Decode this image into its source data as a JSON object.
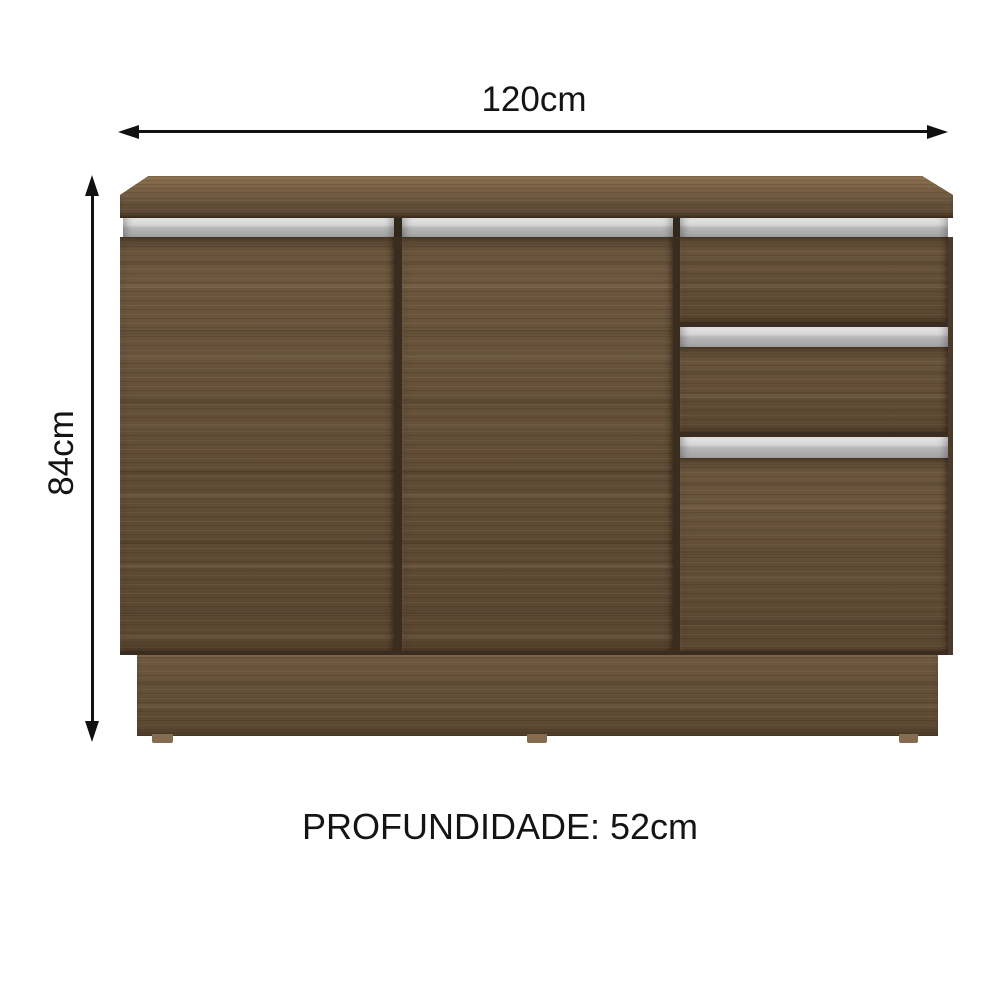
{
  "diagram": {
    "title": "cabinet dimension diagram",
    "width_dimension": {
      "label": "120cm"
    },
    "height_dimension": {
      "label": "84cm"
    },
    "depth_dimension": {
      "label": "PROFUNDIDADE: 52cm"
    }
  },
  "icons": {
    "width_arrow": "double-headed-horizontal-arrow",
    "height_arrow": "double-headed-vertical-arrow"
  },
  "colors": {
    "background": "#ffffff",
    "dimension_text_and_arrows": "#141414",
    "wood_base": "#65503a",
    "wood_top_face": "#83694a",
    "wood_gap_shadow": "#3a2d1f",
    "handle_strip_silver": "#bdbdbd",
    "plinth_foot": "#856c50"
  }
}
